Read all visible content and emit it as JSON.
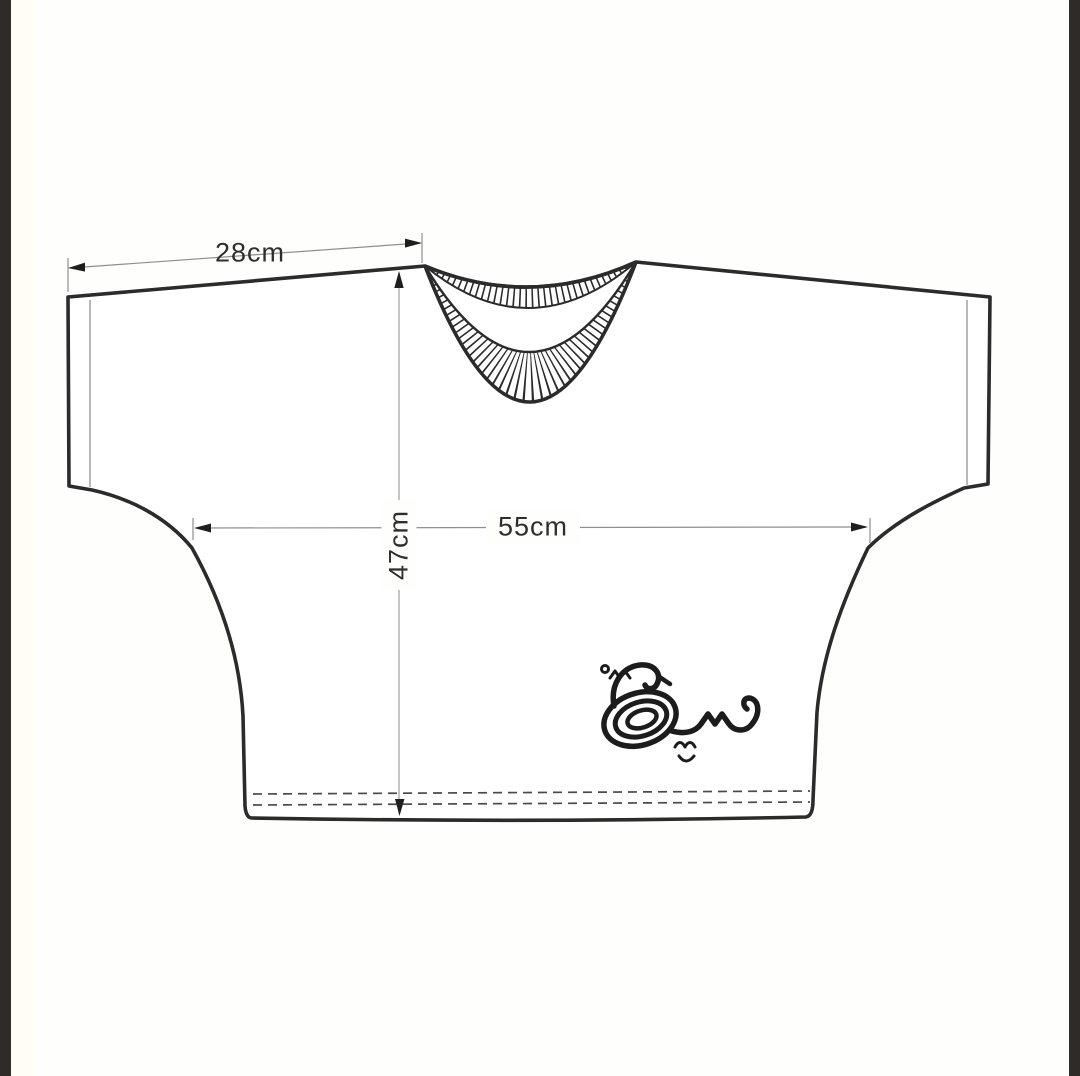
{
  "frame": {
    "left_bar_color": "#2f2b29",
    "right_bar_color": "#2f2b29",
    "background_color": "#fefefd"
  },
  "drawing": {
    "type": "garment-flat-sketch",
    "subject": "boxy cropped t-shirt, front view",
    "line_color": "#2b2b2b",
    "dimension_line_color": "#8f8f8f",
    "measurements": [
      {
        "id": "shoulder-sleeve-width",
        "label": "28cm",
        "orientation": "slanted-horizontal",
        "location": "top left shoulder"
      },
      {
        "id": "chest-width",
        "label": "55cm",
        "orientation": "horizontal",
        "location": "across chest"
      },
      {
        "id": "body-length",
        "label": "47cm",
        "orientation": "vertical",
        "location": "center front, neck to hem"
      }
    ],
    "features": [
      "ribbed crew neckline",
      "drop-shoulder sleeves",
      "double-stitch dashed hem"
    ],
    "logo": {
      "description": "swan-shaped Arabic calligraphy brand mark",
      "position": "lower right of shirt",
      "color": "#1c1c1c"
    }
  }
}
